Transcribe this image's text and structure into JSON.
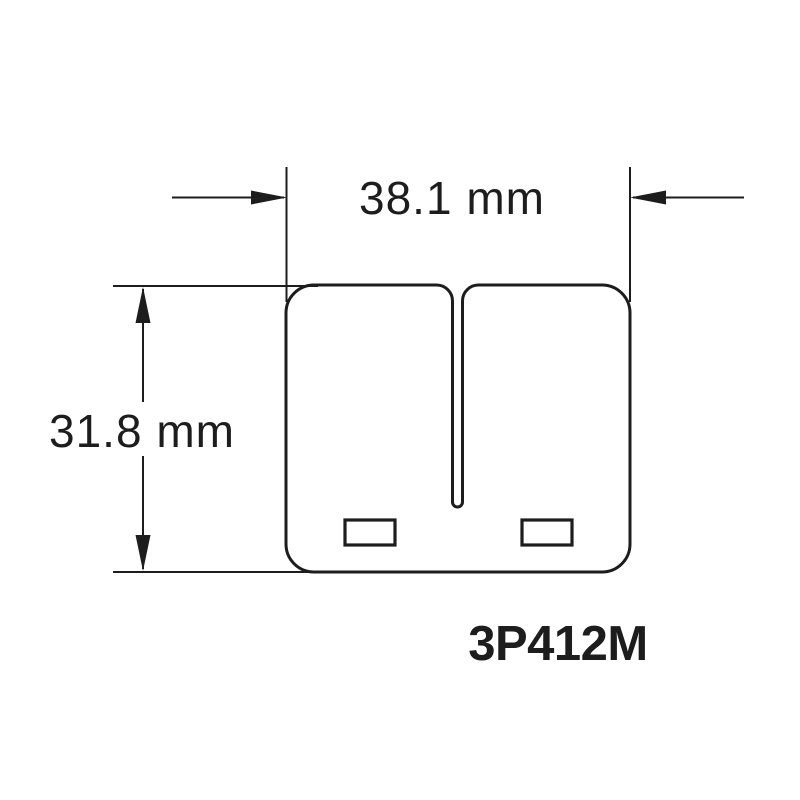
{
  "part": {
    "number": "3P412M"
  },
  "dimensions": {
    "width": {
      "label": "38.1 mm",
      "value_mm": 38.1
    },
    "height": {
      "label": "31.8 mm",
      "value_mm": 31.8
    }
  },
  "colors": {
    "line": "#1d1d1d",
    "text": "#1d1d1d",
    "background": "#ffffff"
  }
}
